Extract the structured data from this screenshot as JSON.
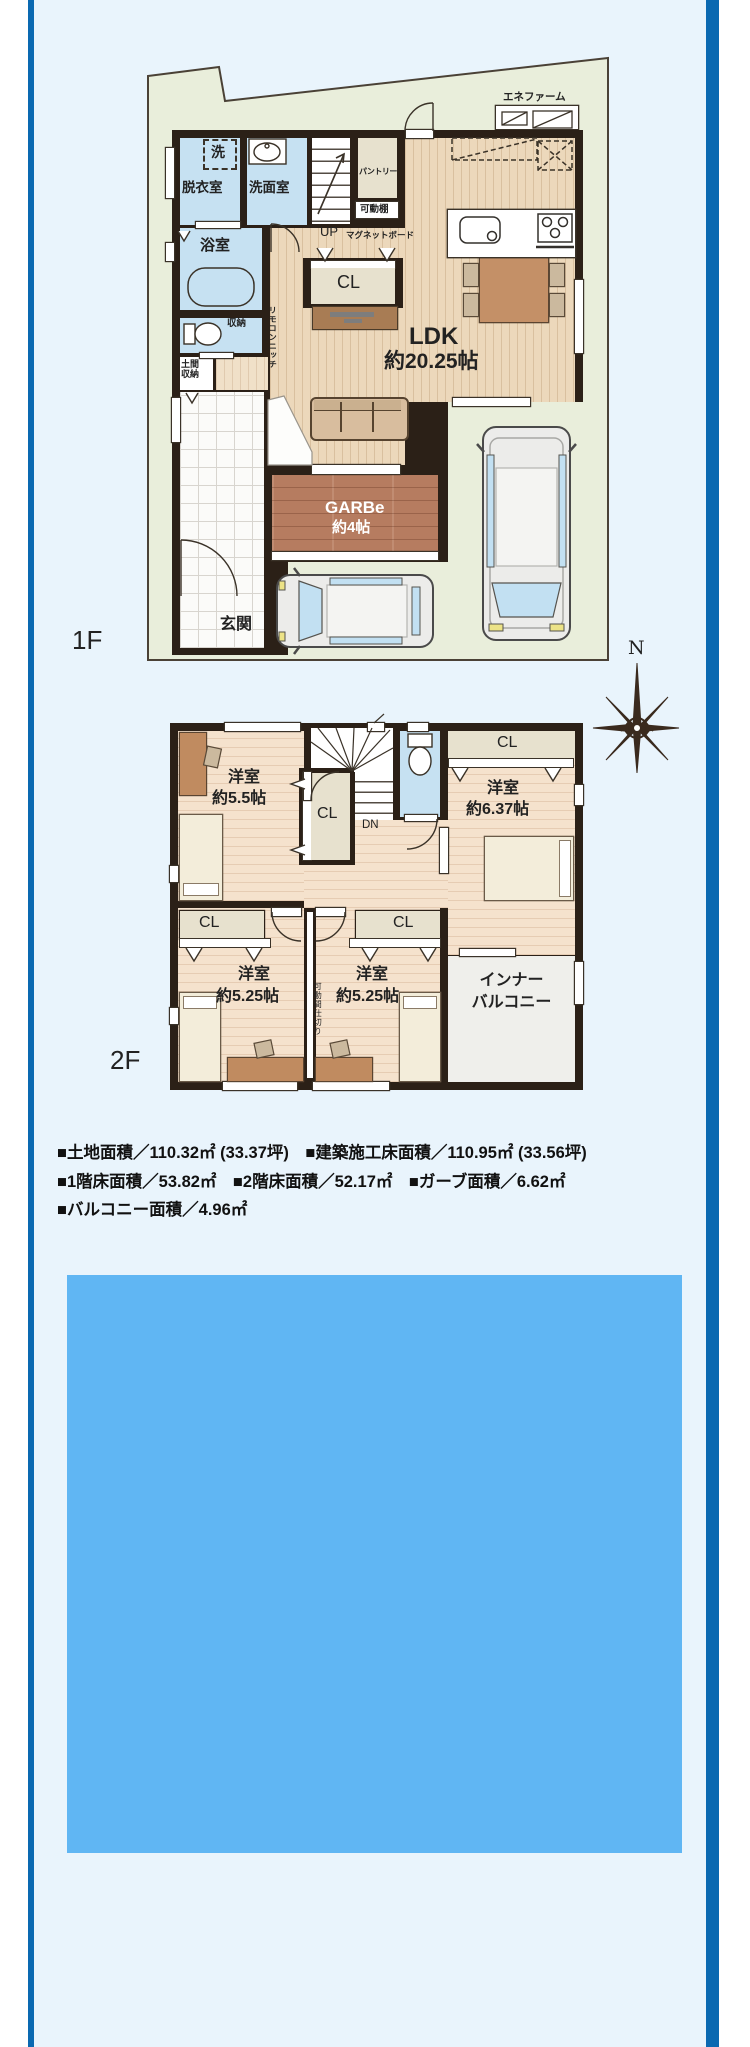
{
  "colors": {
    "accent_bar": "#0a69b1",
    "page_bg": "#e9f4fc",
    "photo_placeholder": "#60b6f3",
    "site_green": "#e9eedb",
    "wall_dark": "#2b2017",
    "wet_room_blue": "#c6e1f2",
    "closet_beige": "#e7e1ce",
    "garage_floor": "#b67c60"
  },
  "floor1": {
    "label": "1F",
    "ldk": {
      "name": "LDK",
      "size": "約20.25帖"
    },
    "garage": {
      "name": "GARBe",
      "size": "約4帖"
    },
    "rooms": {
      "washer": "洗",
      "datsui": "脱衣室",
      "senmen": "洗面室",
      "bath": "浴室",
      "storage": "収納",
      "doma_line1": "土間",
      "doma_line2": "収納",
      "genkan": "玄関",
      "pantry": "パントリー",
      "movable_shelf": "可動棚",
      "magnet_board": "マグネットボード",
      "remote_niche": "リモコンニッチ",
      "closet": "CL",
      "up": "UP",
      "enefarm": "エネファーム"
    }
  },
  "floor2": {
    "label": "2F",
    "rooms": {
      "room_nw": {
        "name": "洋室",
        "size": "約5.5帖"
      },
      "room_ne": {
        "name": "洋室",
        "size": "約6.37帖"
      },
      "room_sw": {
        "name": "洋室",
        "size": "約5.25帖"
      },
      "room_se": {
        "name": "洋室",
        "size": "約5.25帖"
      },
      "closet": "CL",
      "down": "DN",
      "partition": "可動間仕切り",
      "balcony_line1": "インナー",
      "balcony_line2": "バルコニー"
    }
  },
  "compass": {
    "north": "N"
  },
  "area_table": {
    "line1": "■土地面積／110.32㎡ (33.37坪)　■建築施工床面積／110.95㎡ (33.56坪)",
    "line2": "■1階床面積／53.82㎡　■2階床面積／52.17㎡　■ガーブ面積／6.62㎡",
    "line3": "■バルコニー面積／4.96㎡"
  }
}
